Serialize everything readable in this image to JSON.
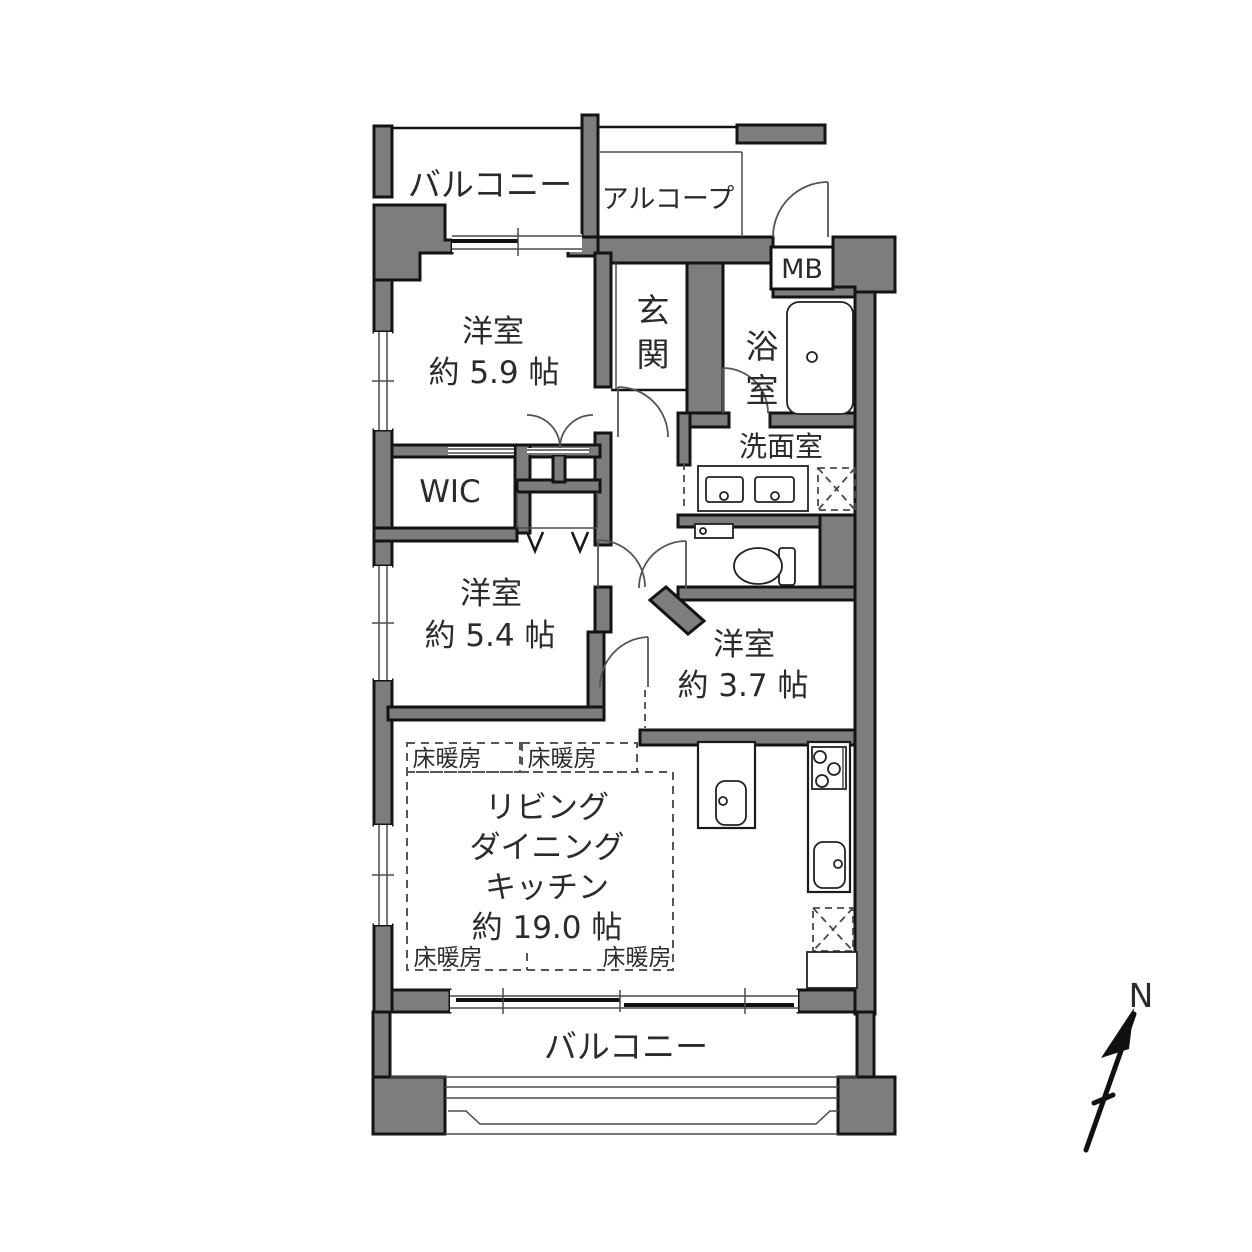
{
  "colors": {
    "wall_fill": "#7d7d7d",
    "wall_stroke": "#141414",
    "background": "#ffffff",
    "text": "#2b2b2b"
  },
  "labels": {
    "balcony_top": "バルコニー",
    "balcony_bottom": "バルコニー",
    "alcove": "アルコープ",
    "meter_box": "MB",
    "entrance": "玄関",
    "bathroom": "浴室",
    "washroom": "洗面室",
    "wic": "WIC",
    "bedroom_a_name": "洋室",
    "bedroom_a_size": "約 5.9 帖",
    "bedroom_b_name": "洋室",
    "bedroom_b_size": "約 5.4 帖",
    "bedroom_c_name": "洋室",
    "bedroom_c_size": "約 3.7 帖",
    "ldk_line1": "リビング",
    "ldk_line2": "ダイニング",
    "ldk_line3": "キッチン",
    "ldk_size": "約 19.0 帖",
    "floor_heating": "床暖房",
    "compass_north": "N"
  }
}
